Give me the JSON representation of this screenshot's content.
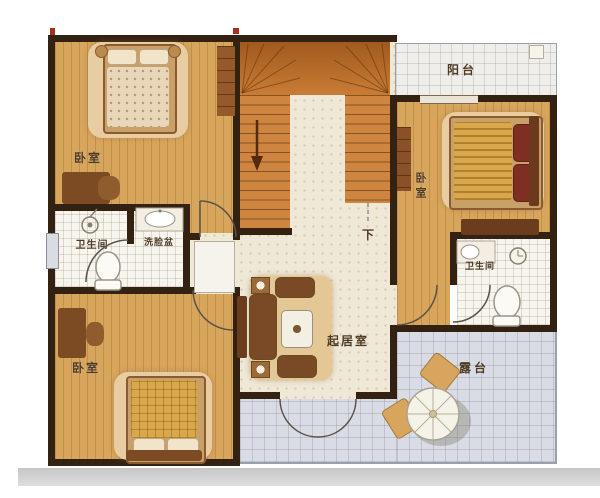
{
  "plan": {
    "type": "floor-plan",
    "rooms": {
      "bedroom_top_left": {
        "label": "卧室"
      },
      "bathroom_left": {
        "label": "卫生间"
      },
      "washroom": {
        "label": "洗脸盆"
      },
      "bedroom_bottom_left": {
        "label": "卧室"
      },
      "living_room": {
        "label": "起居室"
      },
      "stairs": {
        "down_label": "下"
      },
      "bedroom_right": {
        "label": "卧室"
      },
      "bathroom_right": {
        "label": "卫生间"
      },
      "balcony": {
        "label": "阳台"
      },
      "terrace": {
        "label": "露台"
      }
    },
    "colors": {
      "wall": "#332112",
      "wood_floor": "#d8a55c",
      "stair": "#cd8540",
      "hall_floor": "#efe8d6",
      "tile_floor": "#f7f5ee",
      "terrace_floor": "#d9dce4",
      "rug": "#e8cda2",
      "dark_furniture": "#6b3d1d",
      "label_text": "#4e3b24",
      "marker_red": "#a8301e"
    }
  }
}
